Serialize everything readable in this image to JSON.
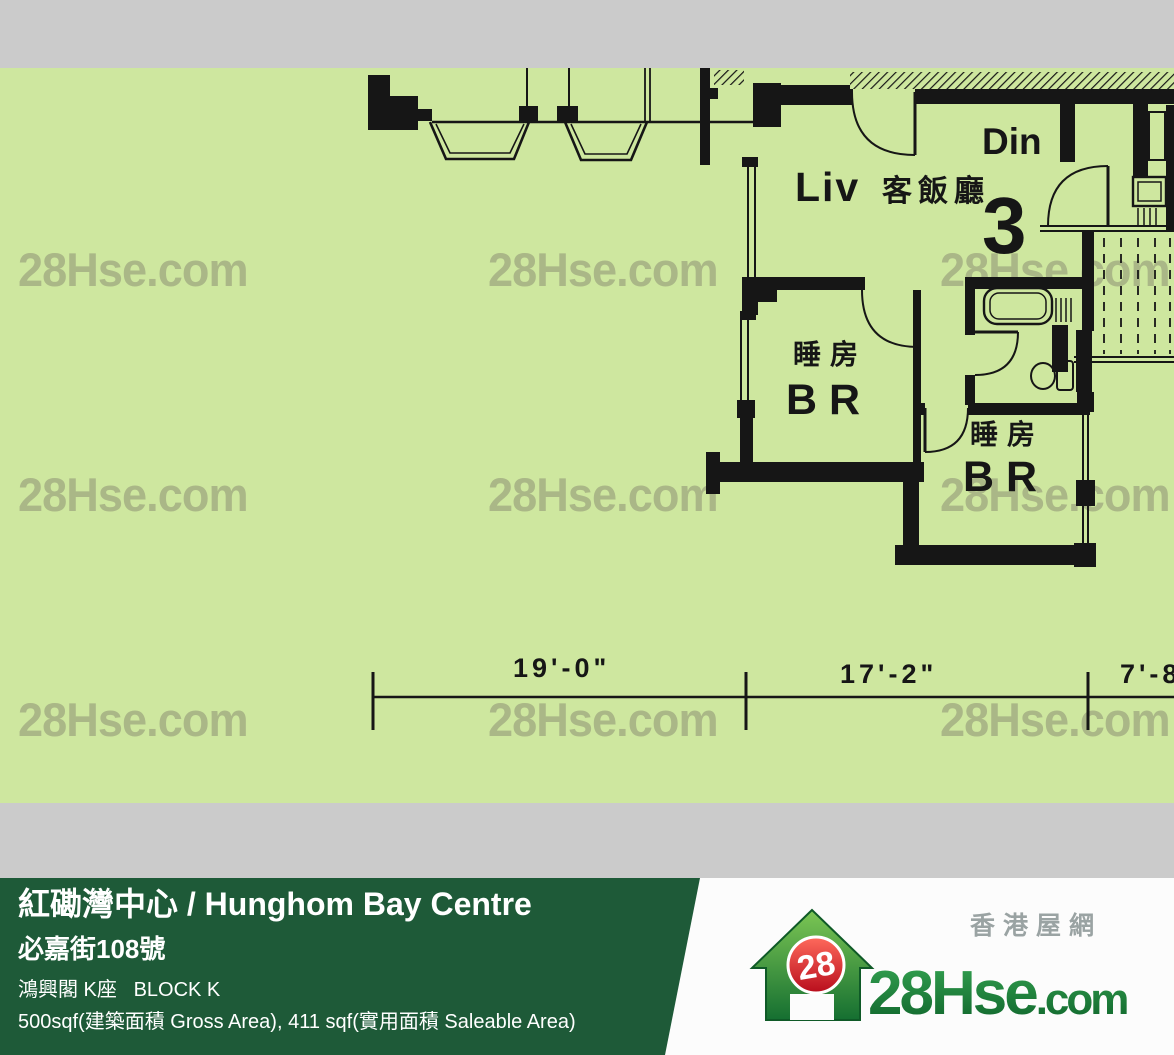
{
  "watermark": {
    "text": "28Hse.com"
  },
  "plan": {
    "rooms": {
      "living_en": "Liv",
      "living_cn": "客飯廳",
      "dining": "Din",
      "unit_number": "3",
      "bedroom_cn": "睡房",
      "bedroom_en": "BR"
    },
    "dimensions": {
      "d1": "19'-0\"",
      "d2": "17'-2\"",
      "d3": "7'-8"
    }
  },
  "info_bar": {
    "title": "紅磡灣中心 / Hunghom Bay Centre",
    "address": "必嘉街108號",
    "block": "鴻興閣 K座   BLOCK K",
    "area": "500sqf(建築面積 Gross Area), 411 sqf(實用面積 Saleable Area)"
  },
  "logo": {
    "badge": "28",
    "name_main": "28Hse",
    "name_suffix": ".com",
    "tagline": "香港屋網"
  },
  "colors": {
    "plan_background": "#cee79f",
    "band_gray": "#cbcbcb",
    "bar_green": "#1e5a38",
    "watermark": "#aab787",
    "line_black": "#161616",
    "logo_red": "#d8121f",
    "logo_green": "#1d8038",
    "tagline_gray": "#9aa3a3"
  }
}
